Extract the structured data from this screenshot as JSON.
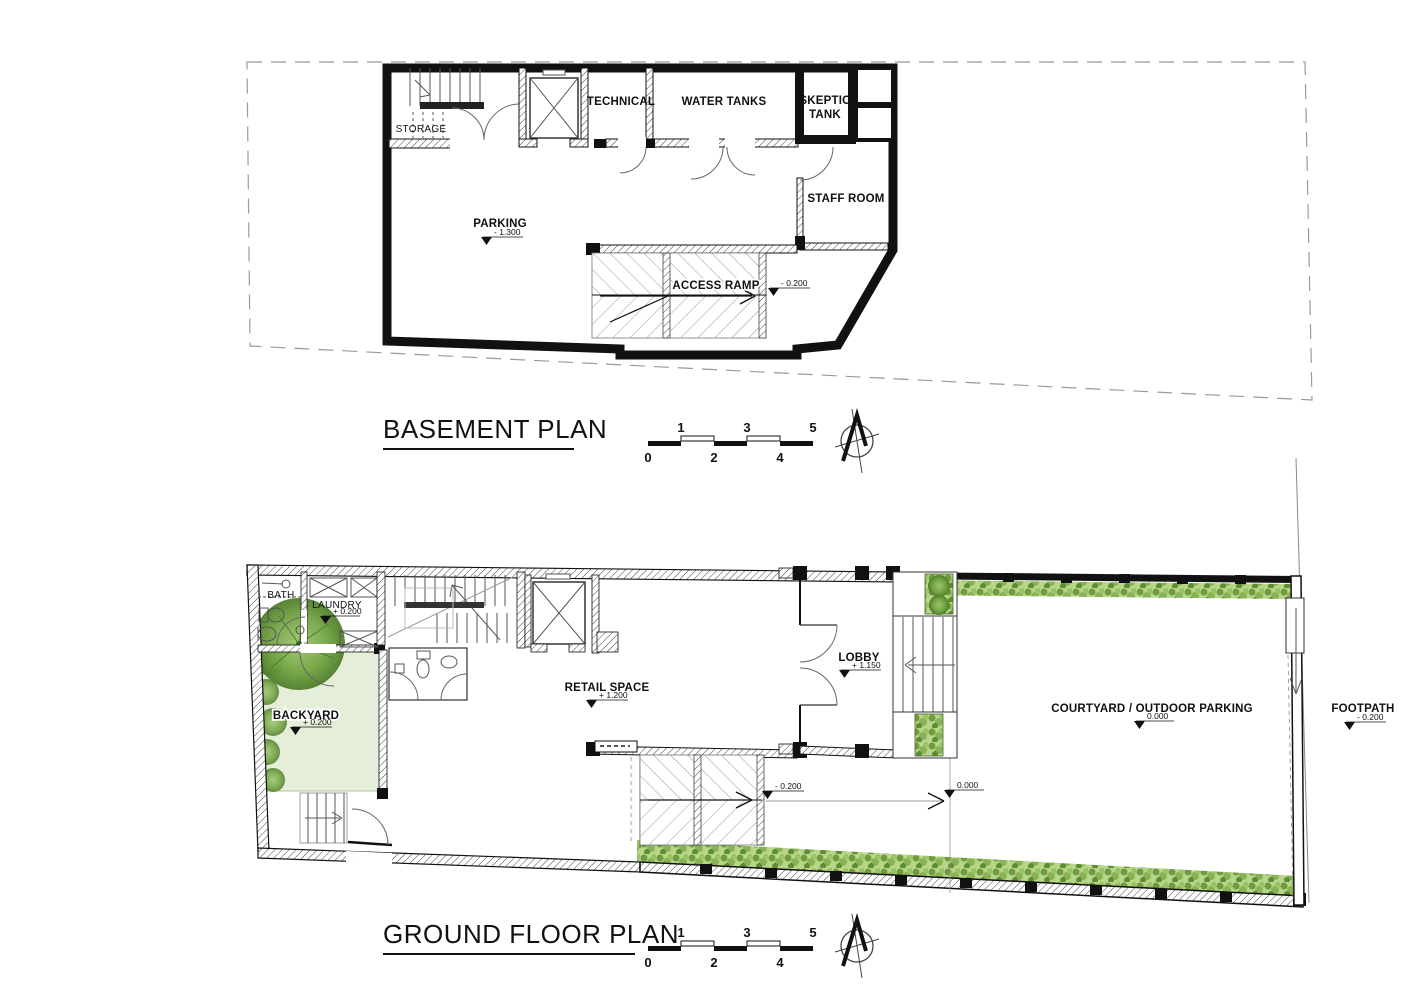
{
  "basement": {
    "title": "BASEMENT PLAN",
    "storage": "STORAGE",
    "technical": "TECHNICAL",
    "water_tanks": "WATER TANKS",
    "skeptic_line1": "SKEPTIC",
    "skeptic_line2": "TANK",
    "staff_room": "STAFF ROOM",
    "parking": "PARKING",
    "parking_level": "- 1.300",
    "access_ramp": "ACCESS RAMP",
    "access_ramp_level": "- 0.200"
  },
  "ground": {
    "title": "GROUND FLOOR PLAN",
    "bath": "BATH",
    "laundry": "LAUNDRY",
    "laundry_level": "+ 0.200",
    "backyard": "BACKYARD",
    "backyard_level": "+ 0.200",
    "retail": "RETAIL SPACE",
    "retail_level": "+ 1.200",
    "lobby": "LOBBY",
    "lobby_level": "+ 1.150",
    "courtyard": "COURTYARD / OUTDOOR PARKING",
    "courtyard_level": "0.000",
    "footpath": "FOOTPATH",
    "footpath_level": "- 0.200",
    "ramp_level": "- 0.200",
    "threshold_level": "0.000"
  },
  "scale_bar": {
    "top": [
      "1",
      "3",
      "5"
    ],
    "bottom": [
      "0",
      "2",
      "4"
    ]
  },
  "colors": {
    "wall_black": "#111111",
    "boundary_gray": "#9a9a9a",
    "pale_green": "#e4eed8",
    "hedge_green": "#7ca84d"
  }
}
